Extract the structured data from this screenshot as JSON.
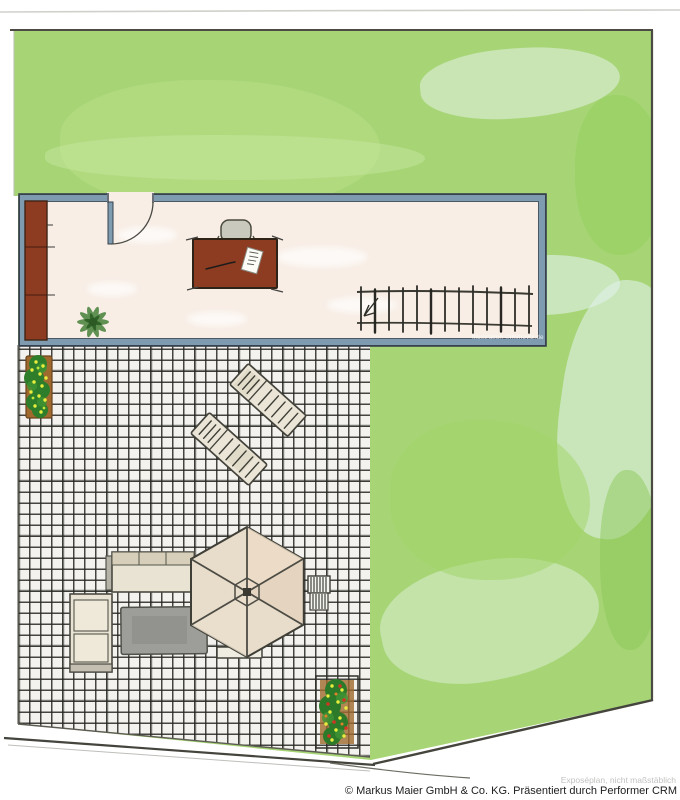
{
  "texts": {
    "watermark": "Illustration ©immoviz.de",
    "disclaimer": "Exposéplan, nicht maßstäblich",
    "copyright": "© Markus Maier GmbH & Co. KG. Präsentiert durch Performer CRM"
  },
  "colors": {
    "lawn": "#a7d576",
    "floor": "#f8eee6",
    "wall": "#7e9bb0",
    "wallEdge": "#36414d",
    "tileBg": "#f3f2ef",
    "wood": "#8d3c22",
    "canvas": "#e8dccb",
    "rug": "#9d9d99",
    "foliage": "#2e7d2b",
    "flowerYellow": "#e9ee3c",
    "flowerRed": "#d03524"
  },
  "plan": {
    "room_objects": [
      "wardrobe",
      "door",
      "desk",
      "office-chair",
      "paper",
      "pen",
      "potted-plant",
      "railing"
    ],
    "terrace_objects": [
      "planter",
      "sun-lounger",
      "sun-lounger",
      "sofa",
      "sofa",
      "rug",
      "parasol",
      "side-table",
      "slatted-table",
      "planter"
    ]
  }
}
